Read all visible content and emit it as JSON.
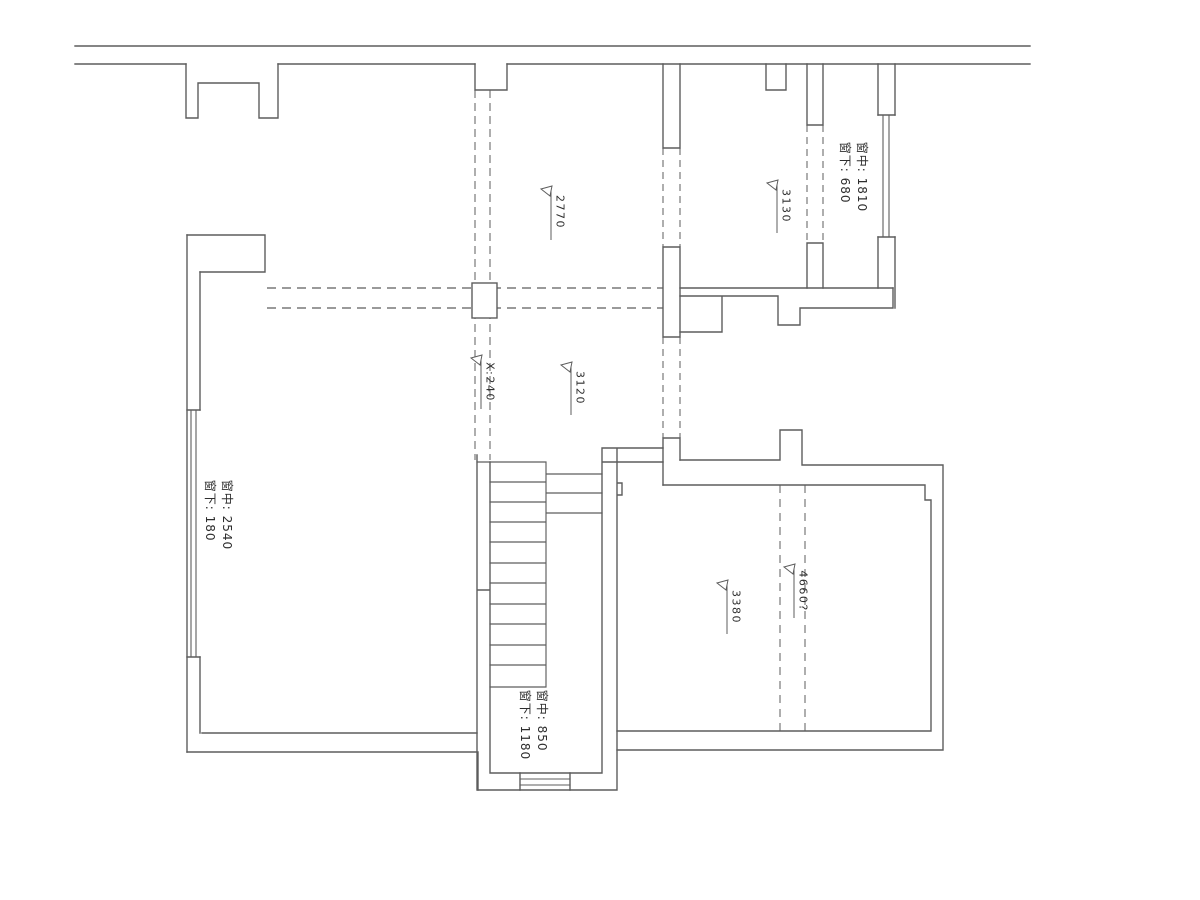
{
  "drawing_type": "floor-plan",
  "windows": {
    "right": {
      "line1": "窗中: 1810",
      "line2": "窗下: 680"
    },
    "left": {
      "line1": "窗中: 2540",
      "line2": "窗下: 180"
    },
    "bottom": {
      "line1": "窗中: 850",
      "line2": "窗下: 1180"
    }
  },
  "dimensions": {
    "d2770": "2770",
    "d3130": "3130",
    "dx240": "X:240",
    "d3120": "3120",
    "d3380": "3380",
    "d4660": "4660?"
  },
  "colors": {
    "wall_line": "#5d5d5d",
    "dashed_line": "#787878",
    "text": "#2e2e2e",
    "background": "#ffffff"
  }
}
